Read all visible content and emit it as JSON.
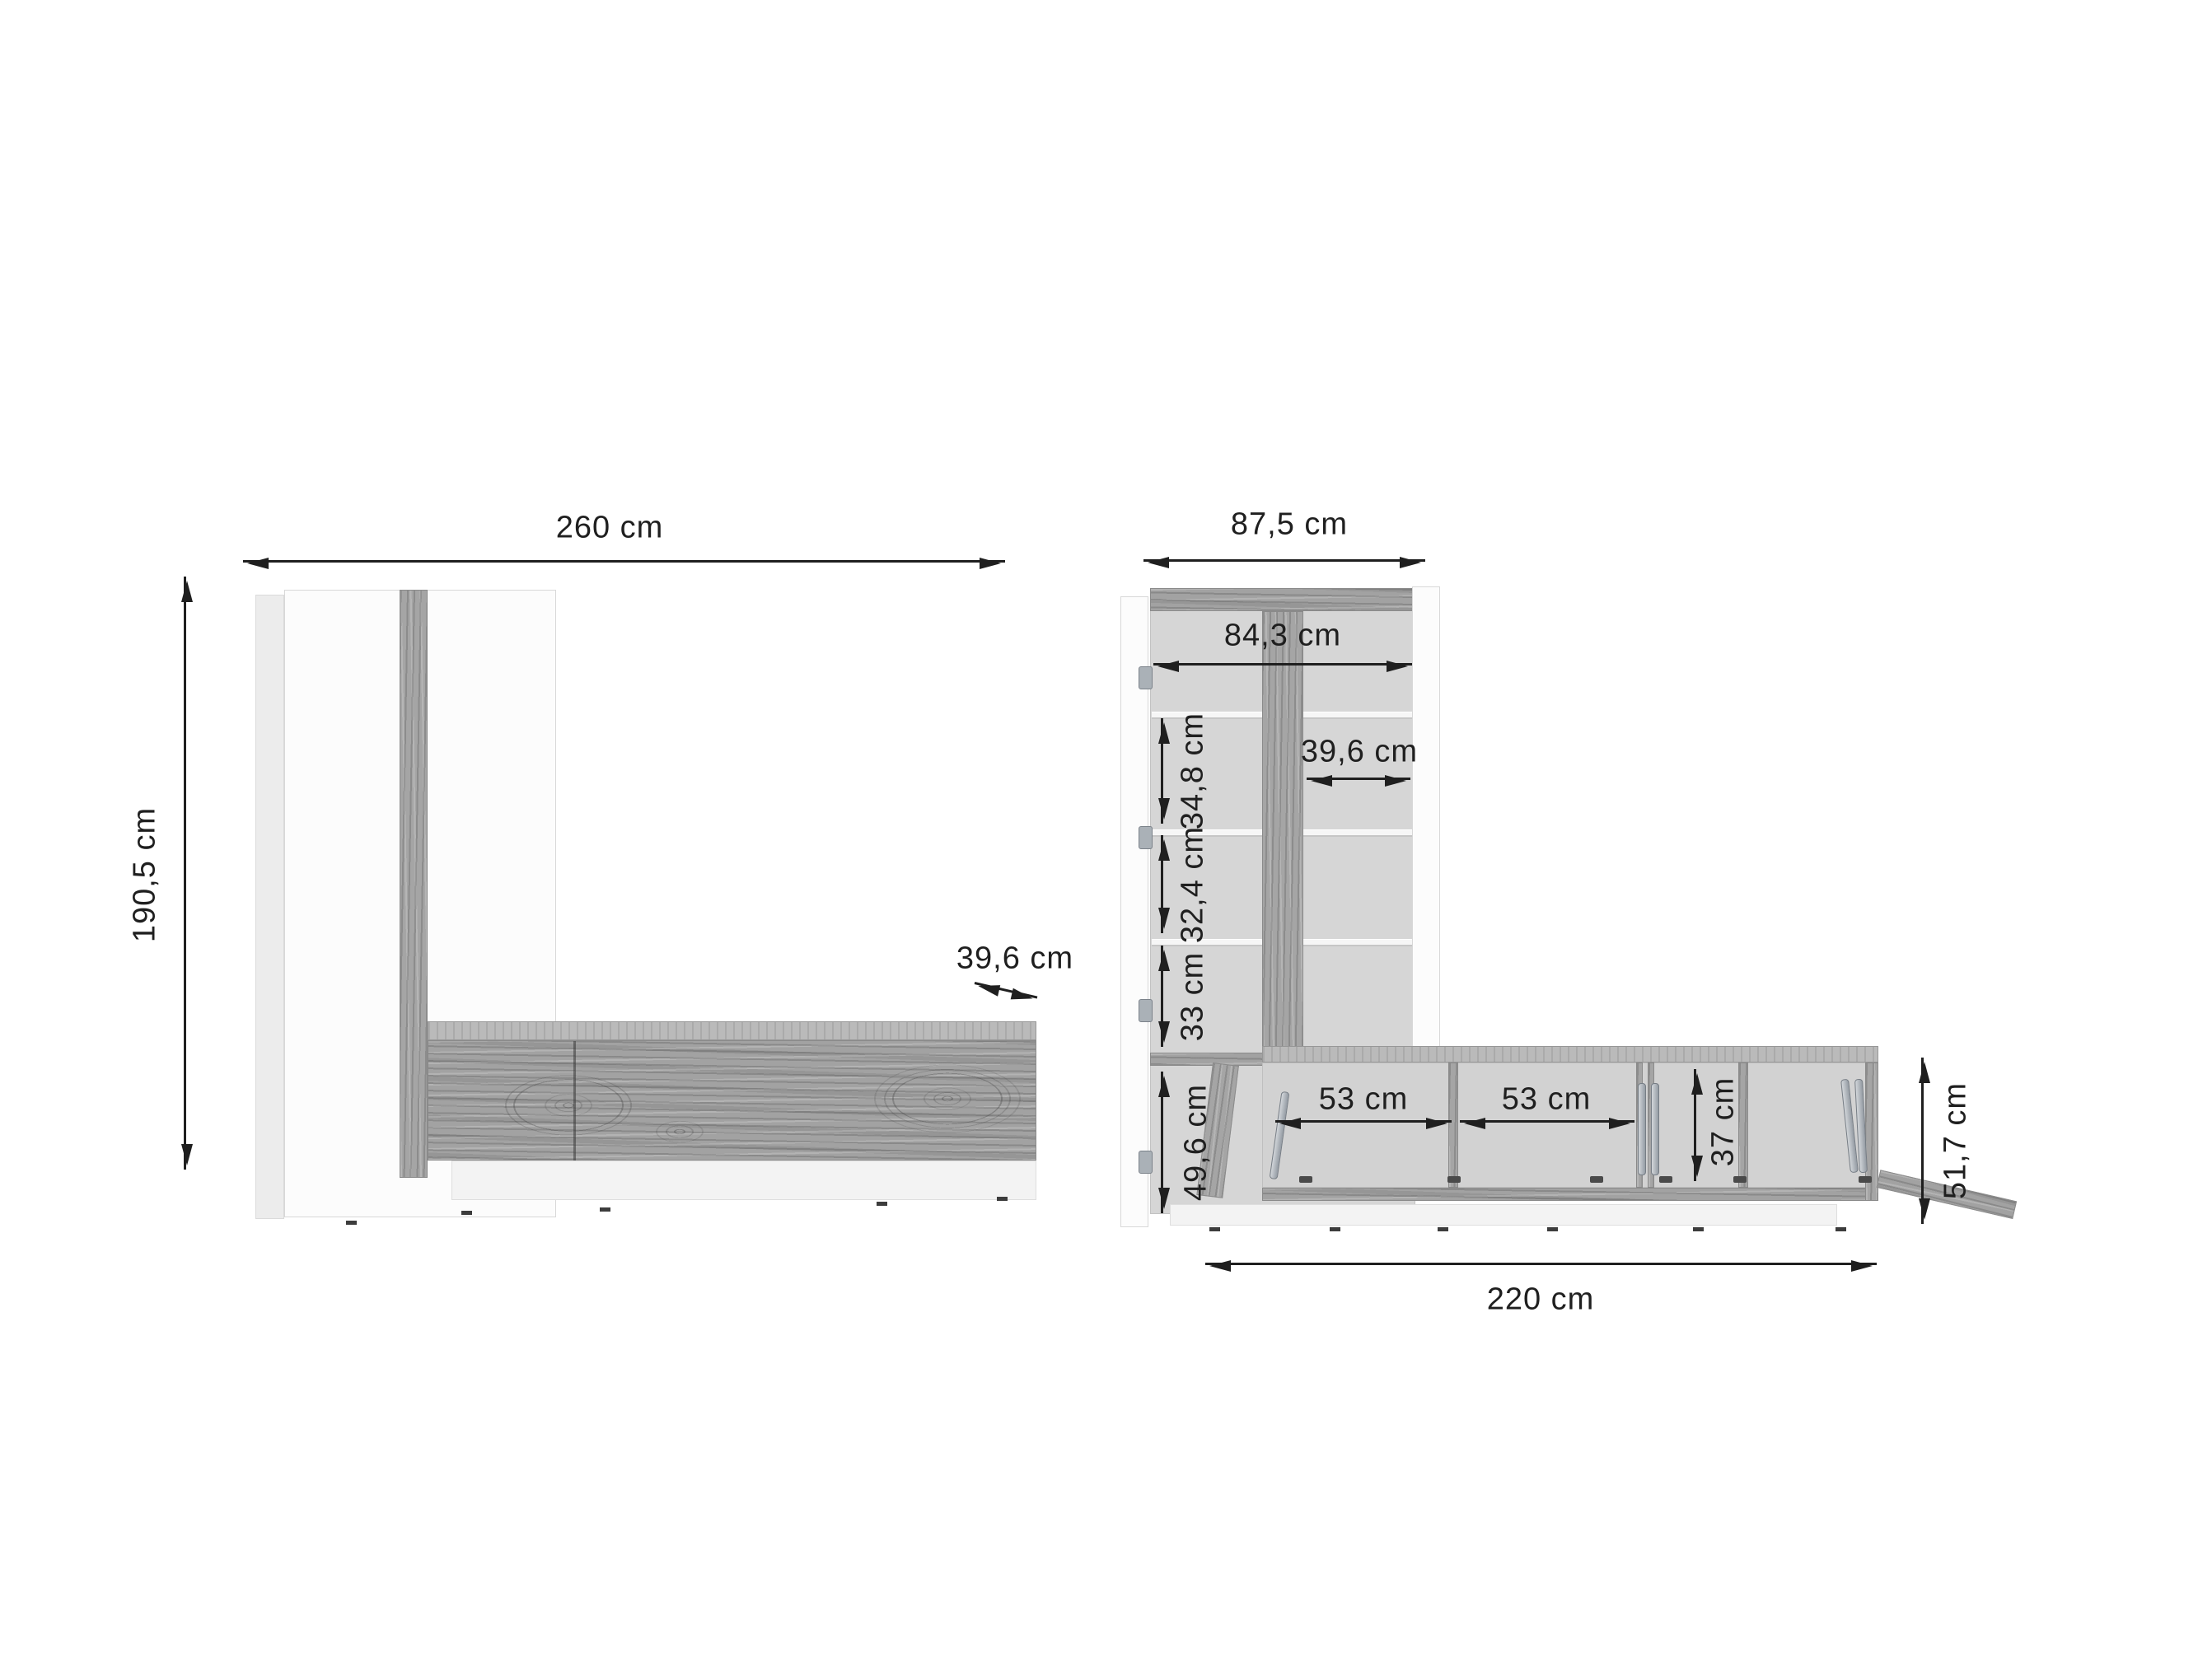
{
  "left_view": {
    "dims": {
      "total_width": "260 cm",
      "total_height": "190,5 cm",
      "tv_depth": "39,6 cm"
    }
  },
  "right_view": {
    "dims": {
      "outer_width": "87,5 cm",
      "inner_width": "84,3 cm",
      "inner_depth": "39,6 cm",
      "section_1": "34,8 cm",
      "section_2": "32,4 cm",
      "section_3": "33 cm",
      "section_4": "49,6 cm",
      "compartment_1": "53 cm",
      "compartment_2": "53 cm",
      "compartment_height": "37 cm",
      "tv_height": "51,7 cm",
      "tv_width": "220 cm"
    }
  },
  "colors": {
    "dimension_line": "#1f1f1f",
    "wood": "#a2a2a2",
    "wood_top": "#bababa",
    "carcass_back": "#d6d6d6",
    "panel_white": "#fcfcfc"
  }
}
